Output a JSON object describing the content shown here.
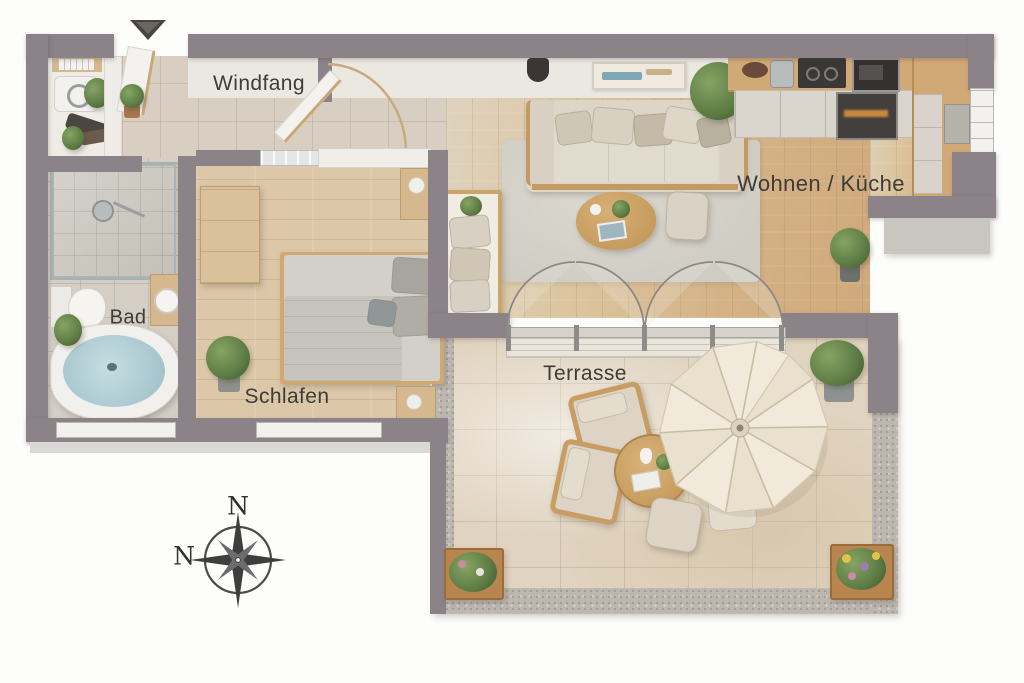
{
  "labels": {
    "windfang": "Windfang",
    "bad": "Bad",
    "schlafen": "Schlafen",
    "wohnen_kueche": "Wohnen / Küche",
    "terrasse": "Terrasse"
  },
  "compass": {
    "top": "N",
    "left": "N"
  },
  "colors": {
    "wall": "#8b8388",
    "entry_floor": "#d8cfc2",
    "bath_floor": "#d4cec5",
    "bedroom_floor": "#dcc7a8",
    "living_floor_wood": "#d4b287",
    "terrace_stone": "#e0d3bf",
    "gravel": "#bcb8b0",
    "wood_accent": "#d1a976",
    "water": "#b4ced6",
    "label_text": "#3e3b38"
  },
  "legend": {
    "windfang_items": [
      "entrance-door",
      "washing-machine",
      "shelf",
      "plants"
    ],
    "bad_items": [
      "walk-in-shower",
      "toilet",
      "washbasin",
      "corner-bathtub"
    ],
    "schlafen_items": [
      "double-bed",
      "wardrobe",
      "nightstands",
      "plant"
    ],
    "wohnen_kueche_items": [
      "sofa",
      "coffee-table",
      "pouf",
      "rug",
      "kitchen-counter",
      "oven",
      "daybed",
      "wall-picture"
    ],
    "terrasse_items": [
      "parasol",
      "armchairs",
      "round-table",
      "poufs",
      "planters"
    ]
  }
}
